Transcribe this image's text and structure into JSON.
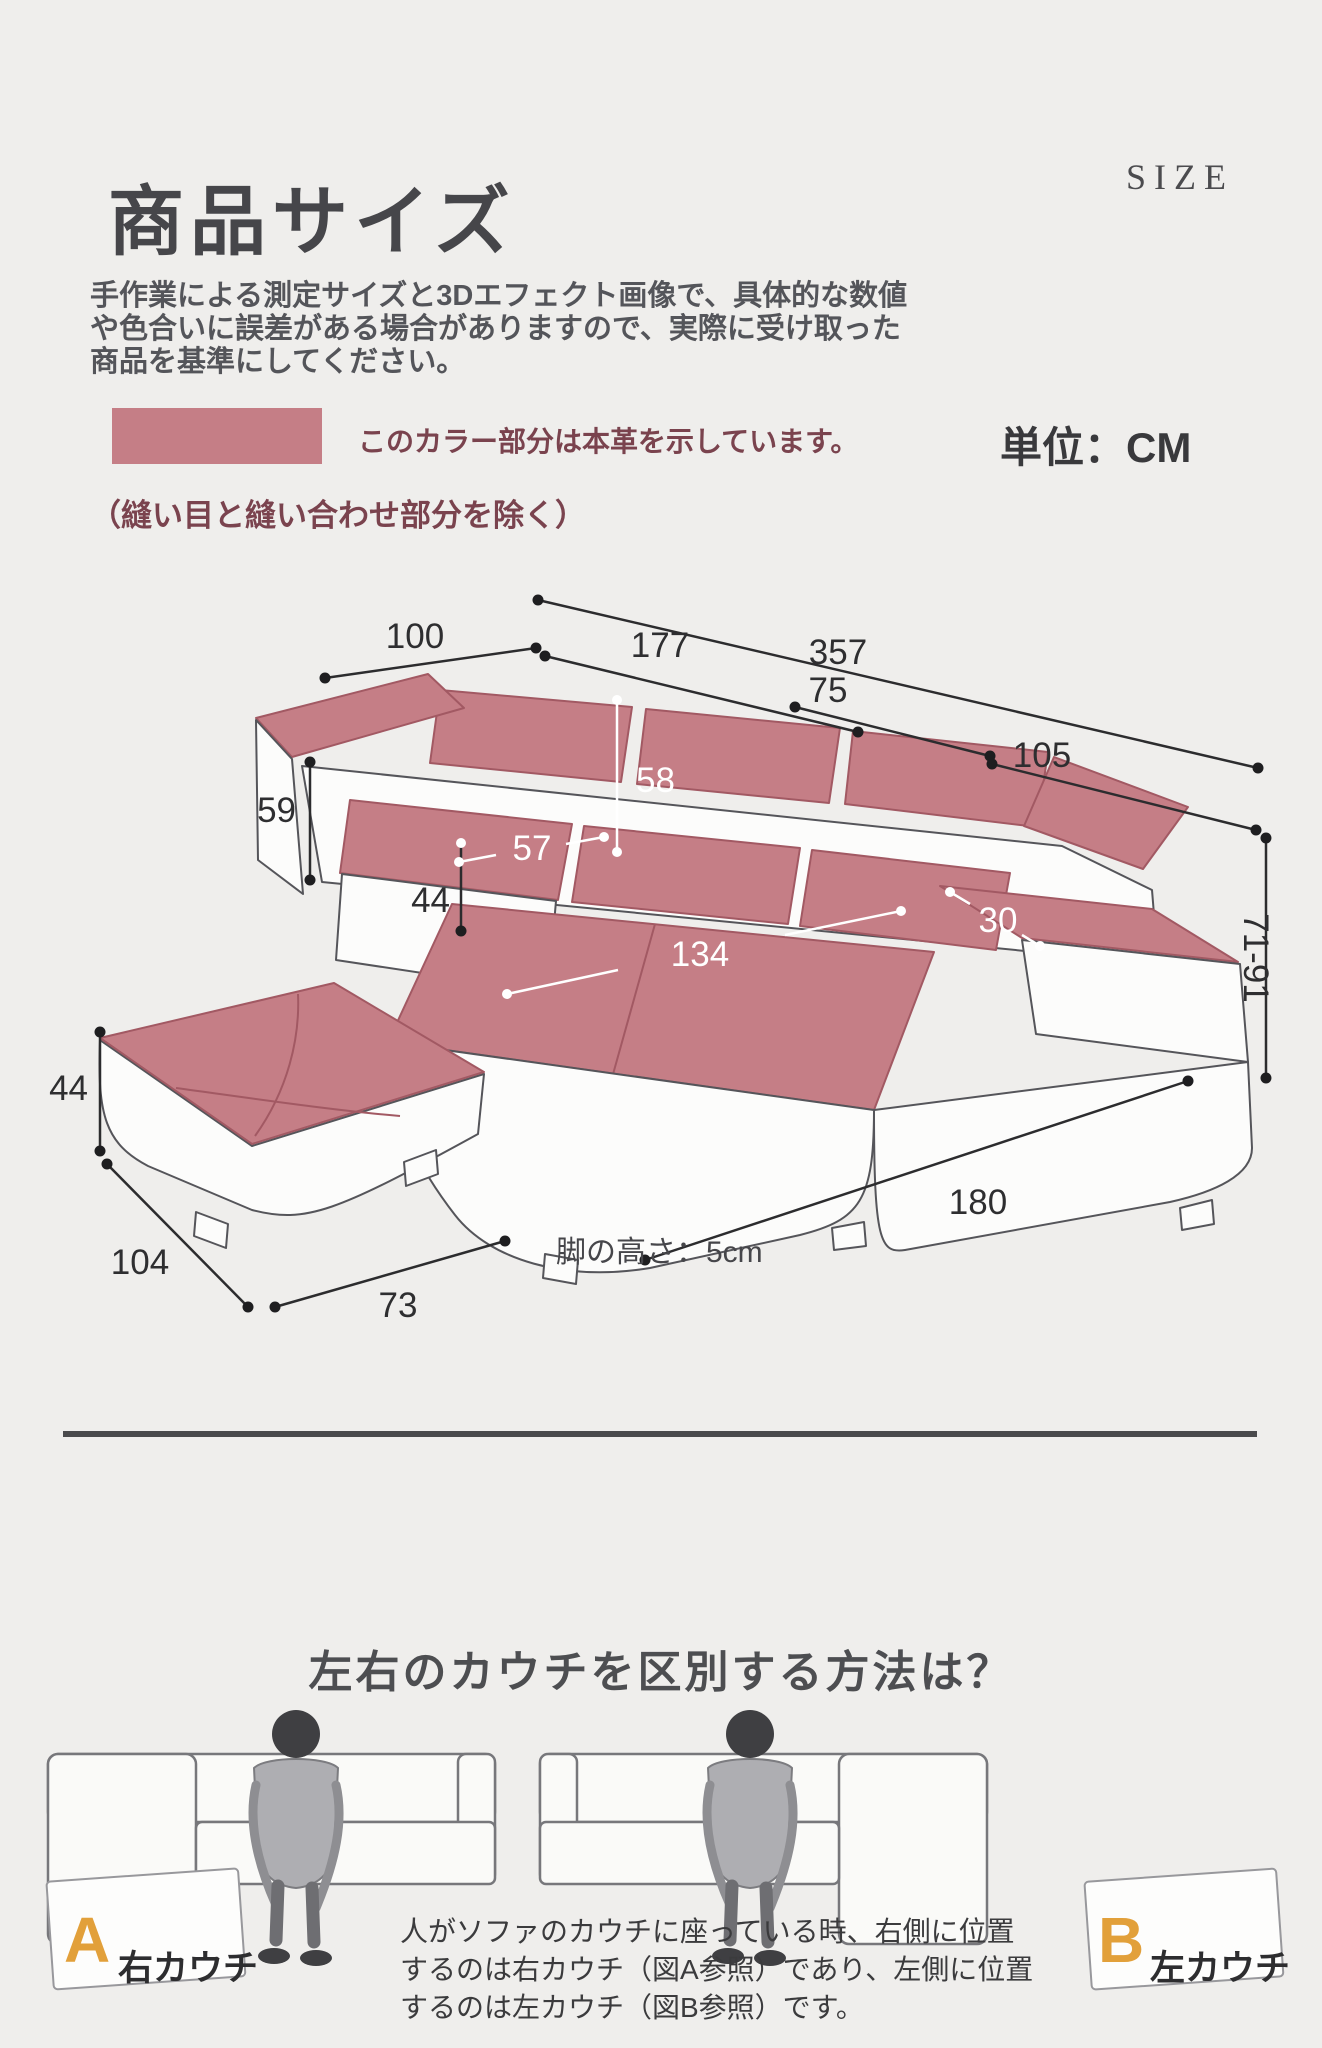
{
  "header": {
    "title": "商品サイズ",
    "size_label": "SIZE",
    "description_lines": [
      "手作業による測定サイズと3Dエフェクト画像で、具体的な数値",
      "や色合いに誤差がある場合がありますので、実際に受け取った",
      "商品を基準にしてください。"
    ],
    "legend_label": "このカラー部分は本革を示しています。",
    "unit_label": "単位：CM",
    "seam_note": "（縫い目と縫い合わせ部分を除く）"
  },
  "colors": {
    "leather_swatch": "#c57e86",
    "accent_maroon": "#7a434e",
    "letter_orange": "#e2a03a",
    "background": "#efeeec"
  },
  "diagram": {
    "leg_height_note": "脚の高さ：5cm",
    "dims": {
      "d357": "357",
      "d100": "100",
      "d177": "177",
      "d75": "75",
      "d105": "105",
      "d58": "58",
      "d59": "59",
      "d57": "57",
      "d44_seat": "44",
      "d134": "134",
      "d30": "30",
      "d71_91": "71-91",
      "d44_ottoman": "44",
      "d104": "104",
      "d73": "73",
      "d180": "180"
    }
  },
  "guide": {
    "heading": "左右のカウチを区別する方法は？",
    "figure_a_letter": "A",
    "figure_a_label": "右カウチ",
    "figure_b_letter": "B",
    "figure_b_label": "左カウチ",
    "description_lines": [
      "人がソファのカウチに座っている時、右側に位置",
      "するのは右カウチ（図A参照）であり、左側に位置",
      "するのは左カウチ（図B参照）です。"
    ]
  }
}
